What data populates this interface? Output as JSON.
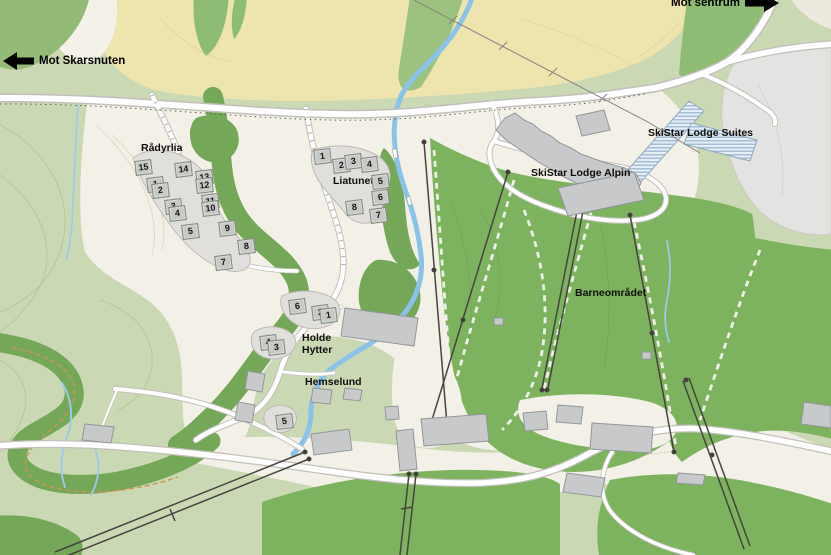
{
  "map": {
    "type": "ski-resort-overview-map",
    "direction_signs": [
      {
        "id": "skarsnuten",
        "label": "Mot Skarsnuten",
        "direction": "left"
      },
      {
        "id": "sentrum",
        "label": "Mot sentrum",
        "direction": "right"
      }
    ],
    "area_labels": [
      {
        "id": "radyrlia",
        "text": "Rådyrlia",
        "x": 141,
        "y": 142
      },
      {
        "id": "liatunet",
        "text": "Liatunet",
        "x": 333,
        "y": 175
      },
      {
        "id": "skistar-lodge-suites",
        "text": "SkiStar Lodge Suites",
        "x": 648,
        "y": 127
      },
      {
        "id": "skistar-lodge-alpin",
        "text": "SkiStar Lodge Alpin",
        "x": 531,
        "y": 167
      },
      {
        "id": "barneomradet",
        "text": "Barneområdet",
        "x": 575,
        "y": 287
      },
      {
        "id": "holde-hytter-line1",
        "text": "Holde",
        "x": 302,
        "y": 332
      },
      {
        "id": "holde-hytter-line2",
        "text": "Hytter",
        "x": 302,
        "y": 344
      },
      {
        "id": "hemselund",
        "text": "Hemselund",
        "x": 305,
        "y": 376
      }
    ],
    "lot_clusters": [
      {
        "name": "Rådyrlia",
        "lots": [
          {
            "n": "15",
            "x": 142,
            "y": 166
          },
          {
            "n": "14",
            "x": 182,
            "y": 168
          },
          {
            "n": "1",
            "x": 154,
            "y": 183
          },
          {
            "n": "2",
            "x": 159,
            "y": 189
          },
          {
            "n": "13",
            "x": 203,
            "y": 176
          },
          {
            "n": "12",
            "x": 203,
            "y": 184
          },
          {
            "n": "3",
            "x": 172,
            "y": 205
          },
          {
            "n": "4",
            "x": 176,
            "y": 212
          },
          {
            "n": "11",
            "x": 209,
            "y": 200
          },
          {
            "n": "10",
            "x": 209,
            "y": 207
          },
          {
            "n": "5",
            "x": 189,
            "y": 230
          },
          {
            "n": "9",
            "x": 226,
            "y": 227
          },
          {
            "n": "8",
            "x": 245,
            "y": 245
          },
          {
            "n": "7",
            "x": 222,
            "y": 261
          }
        ]
      },
      {
        "name": "Liatunet",
        "lots": [
          {
            "n": "1",
            "x": 321,
            "y": 155
          },
          {
            "n": "2",
            "x": 340,
            "y": 164
          },
          {
            "n": "3",
            "x": 352,
            "y": 160
          },
          {
            "n": "4",
            "x": 368,
            "y": 163
          },
          {
            "n": "5",
            "x": 379,
            "y": 180
          },
          {
            "n": "6",
            "x": 379,
            "y": 196
          },
          {
            "n": "8",
            "x": 353,
            "y": 206
          },
          {
            "n": "7",
            "x": 377,
            "y": 214
          }
        ]
      },
      {
        "name": "Holde Hytter",
        "lots": [
          {
            "n": "6",
            "x": 296,
            "y": 305
          },
          {
            "n": "2",
            "x": 319,
            "y": 311
          },
          {
            "n": "1",
            "x": 327,
            "y": 314
          },
          {
            "n": "4",
            "x": 267,
            "y": 341
          },
          {
            "n": "3",
            "x": 275,
            "y": 346
          }
        ]
      },
      {
        "name": "Hemselund",
        "lots": [
          {
            "n": "5",
            "x": 283,
            "y": 420
          }
        ]
      }
    ],
    "colors": {
      "meadow_green": "#cbd8b4",
      "field_yellow": "#ede4ae",
      "forest_green": "#74a758",
      "developed_cream": "#f3f0e7",
      "gravel_gray": "#e3e3e1",
      "water_blue": "#8ac2e8",
      "building_gray": "#c7c9ca",
      "hatch_blue": "#a3bfd8"
    }
  }
}
